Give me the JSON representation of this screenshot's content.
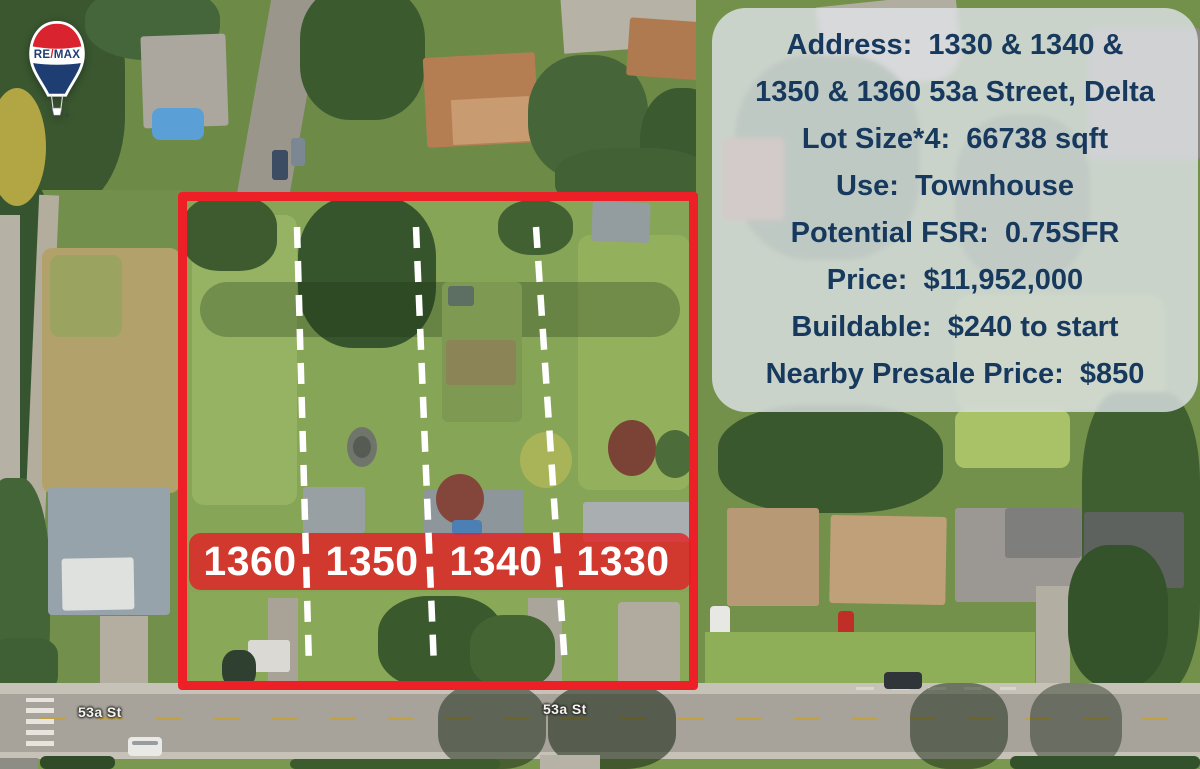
{
  "logo": {
    "brand_re": "RE",
    "brand_slash": "/",
    "brand_max": "MAX",
    "registered": "®"
  },
  "info_panel": {
    "lines": [
      "Address:  1330 & 1340 &",
      "1350 & 1360 53a Street, Delta",
      "Lot Size*4:  66738 sqft",
      "Use:  Townhouse",
      "Potential FSR:  0.75SFR",
      "Price:  $11,952,000",
      "Buildable:  $240 to start",
      "Nearby Presale Price:  $850"
    ]
  },
  "map": {
    "lot_labels": [
      "1360",
      "1350",
      "1340",
      "1330"
    ],
    "street_labels": [
      "53a St",
      "53a St"
    ]
  },
  "colors": {
    "boundary_red": "#ee2027",
    "band_red": "rgba(228,30,36,0.8)",
    "panel_bg": "rgba(224,228,232,0.8)",
    "panel_text": "#17395e",
    "balloon_red": "#d92430",
    "balloon_blue": "#1d3d73",
    "label_text": "#ffffff"
  }
}
